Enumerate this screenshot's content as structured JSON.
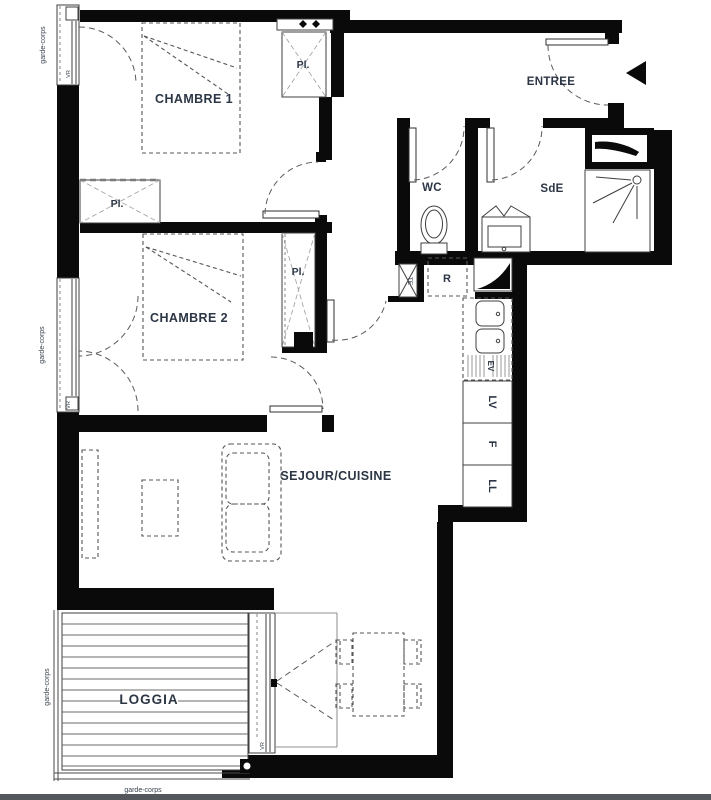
{
  "plan": {
    "room_labels": {
      "chambre1": "CHAMBRE 1",
      "chambre2": "CHAMBRE 2",
      "entree": "ENTREE",
      "wc": "WC",
      "sde": "SdE",
      "sejour_cuisine": "SEJOUR/CUISINE",
      "loggia": "LOGGIA"
    },
    "closet_label": "Pl.",
    "equipment_labels": {
      "refrigerateur": "R",
      "tableau_electrique": "TE",
      "evier": "EV",
      "lave_vaisselle": "LV",
      "four": "F",
      "lave_linge": "LL"
    },
    "annotation_labels": {
      "garde_corps": "garde-corps",
      "volet_roulant": "VR"
    },
    "colors": {
      "wall": "#0a0a0a",
      "text": "#2c3645",
      "thin_line": "#3f3f3f",
      "furniture_dash": "#565656",
      "closet_cross": "#a6a6a6",
      "bottom_bar": "#54585c",
      "background": "#ffffff"
    }
  }
}
